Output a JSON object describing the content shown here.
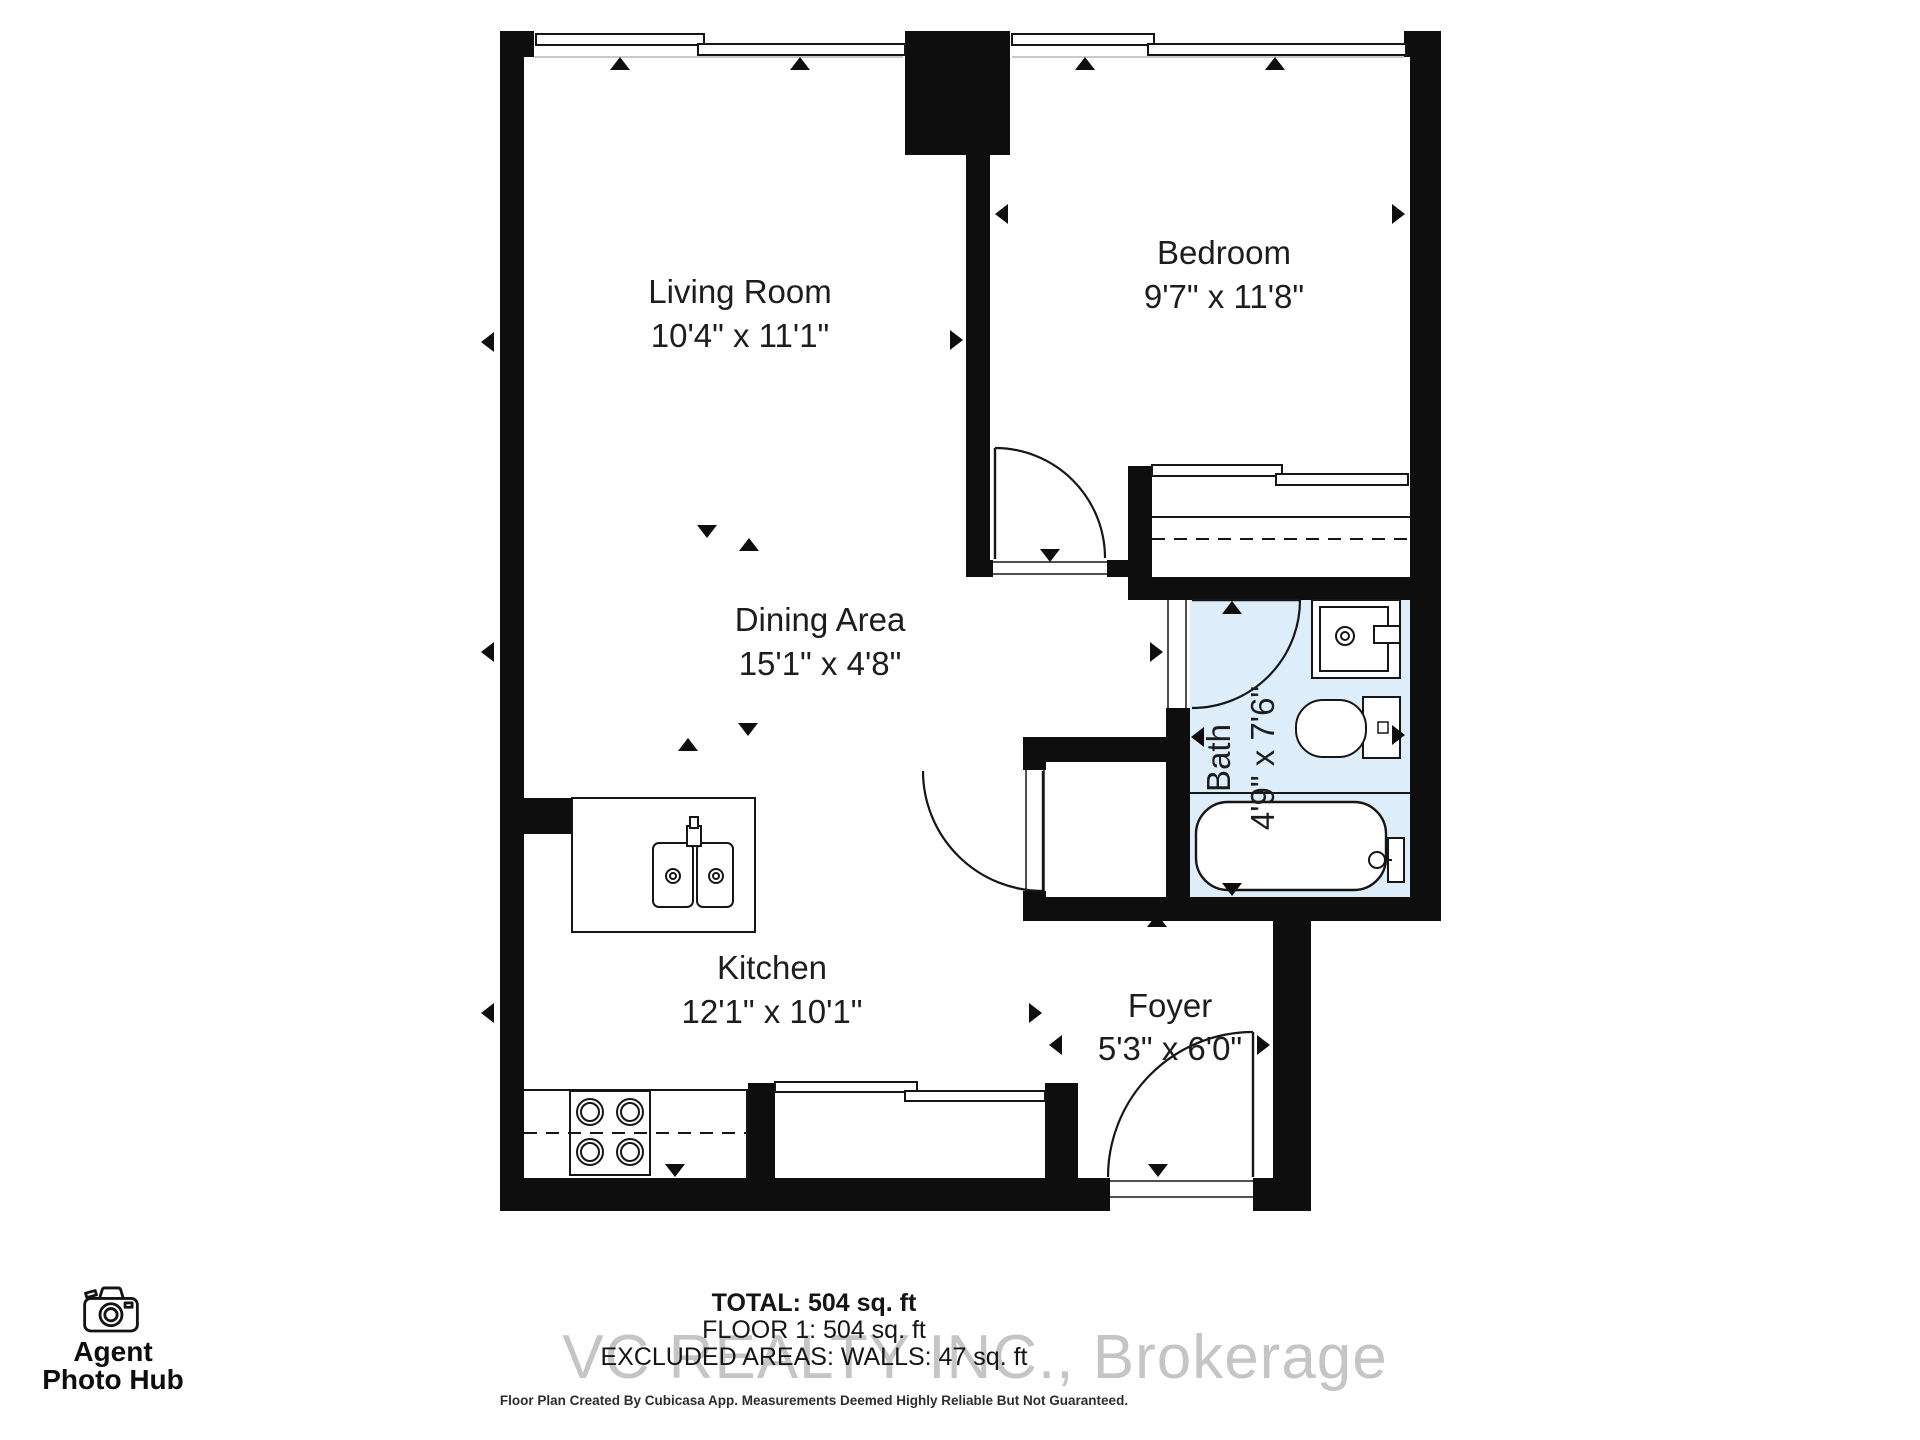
{
  "rooms": [
    {
      "id": "living-room",
      "label": "Living Room",
      "dims": "10'4\" x 11'1\"",
      "nx": 740,
      "ny": 303,
      "dx": 740,
      "dy": 347
    },
    {
      "id": "bedroom",
      "label": "Bedroom",
      "dims": "9'7\" x 11'8\"",
      "nx": 1224,
      "ny": 264,
      "dx": 1224,
      "dy": 308
    },
    {
      "id": "dining-area",
      "label": "Dining Area",
      "dims": "15'1\" x 4'8\"",
      "nx": 820,
      "ny": 631,
      "dx": 820,
      "dy": 675
    },
    {
      "id": "kitchen",
      "label": "Kitchen",
      "dims": "12'1\" x 10'1\"",
      "nx": 772,
      "ny": 979,
      "dx": 772,
      "dy": 1023
    },
    {
      "id": "foyer",
      "label": "Foyer",
      "dims": "5'3\" x 6'0\"",
      "nx": 1170,
      "ny": 1017,
      "dx": 1170,
      "dy": 1060
    },
    {
      "id": "bath",
      "label": "Bath",
      "dims": "4'9\" x 7'6\"",
      "nx": 1230,
      "ny": 758,
      "dx": 1274,
      "dy": 758,
      "rot": -90
    }
  ],
  "stats": {
    "total": "TOTAL: 504 sq. ft",
    "floor": "FLOOR 1: 504 sq. ft",
    "excluded": "EXCLUDED AREAS: WALLS: 47 sq. ft"
  },
  "watermark": "VC REALTY INC., Brokerage",
  "disclaimer": "Floor Plan Created By Cubicasa App. Measurements Deemed Highly Reliable But Not Guaranteed.",
  "logo": {
    "line1": "Agent",
    "line2": "Photo Hub"
  },
  "plan": {
    "wall_color": "#0e0e0e",
    "line_color": "#161616",
    "text_color": "#1d1d1d",
    "bath_fill": "#ddedf9",
    "window_inner_color": "#c9c9c9",
    "fills": [
      {
        "n": "bath-floor",
        "x": 1190,
        "y": 600,
        "w": 220,
        "h": 297,
        "c": "#ddedf9"
      }
    ],
    "walls": [
      [
        500,
        31,
        24,
        1180
      ],
      [
        500,
        31,
        34,
        26
      ],
      [
        905,
        31,
        105,
        124
      ],
      [
        1404,
        31,
        37,
        26
      ],
      [
        1410,
        31,
        31,
        890
      ],
      [
        966,
        155,
        24,
        406
      ],
      [
        966,
        560,
        28,
        17
      ],
      [
        1107,
        560,
        45,
        17
      ],
      [
        1128,
        466,
        24,
        111
      ],
      [
        1128,
        577,
        313,
        23
      ],
      [
        1166,
        708,
        24,
        213
      ],
      [
        1023,
        737,
        143,
        25
      ],
      [
        1023,
        737,
        23,
        35
      ],
      [
        1023,
        891,
        23,
        30
      ],
      [
        1023,
        897,
        418,
        24
      ],
      [
        1273,
        897,
        38,
        314
      ],
      [
        500,
        1178,
        610,
        33
      ],
      [
        1253,
        1178,
        58,
        33
      ],
      [
        748,
        1083,
        27,
        95
      ],
      [
        1045,
        1083,
        33,
        95
      ],
      [
        500,
        798,
        72,
        36
      ]
    ],
    "white_rects": [
      [
        993,
        560,
        114,
        17
      ],
      [
        1166,
        600,
        24,
        108
      ],
      [
        1023,
        770,
        23,
        121
      ],
      [
        1110,
        1178,
        143,
        33
      ]
    ],
    "pane_rects": [
      [
        536,
        34,
        168,
        11
      ],
      [
        698,
        44,
        207,
        11
      ],
      [
        1012,
        34,
        142,
        11
      ],
      [
        1148,
        44,
        258,
        11
      ],
      [
        1152,
        465,
        130,
        11
      ],
      [
        1276,
        474,
        132,
        11
      ],
      [
        775,
        1082,
        142,
        10
      ],
      [
        905,
        1091,
        140,
        10
      ]
    ],
    "outline_rects": [
      {
        "n": "kitchen-island",
        "x": 572,
        "y": 798,
        "w": 183,
        "h": 134,
        "sw": 2
      },
      {
        "n": "stove",
        "x": 570,
        "y": 1091,
        "w": 80,
        "h": 84,
        "sw": 2
      },
      {
        "n": "sink-basin-left",
        "x": 653,
        "y": 843,
        "w": 40,
        "h": 64,
        "rx": 6,
        "sw": 2
      },
      {
        "n": "sink-basin-right",
        "x": 697,
        "y": 843,
        "w": 36,
        "h": 64,
        "rx": 6,
        "sw": 2
      },
      {
        "n": "sink-faucet",
        "x": 687,
        "y": 826,
        "w": 14,
        "h": 20,
        "sw": 2
      },
      {
        "n": "sink-faucet-nub",
        "x": 690,
        "y": 817,
        "w": 8,
        "h": 11,
        "sw": 2
      },
      {
        "n": "bath-vanity",
        "x": 1312,
        "y": 600,
        "w": 88,
        "h": 78,
        "sw": 2
      },
      {
        "n": "bath-vanity-basin",
        "x": 1320,
        "y": 607,
        "w": 68,
        "h": 64,
        "sw": 2
      },
      {
        "n": "bath-vanity-soap",
        "x": 1374,
        "y": 626,
        "w": 26,
        "h": 17,
        "sw": 2
      },
      {
        "n": "toilet-tank",
        "x": 1363,
        "y": 697,
        "w": 37,
        "h": 61,
        "sw": 2
      },
      {
        "n": "toilet-button",
        "x": 1378,
        "y": 722,
        "w": 10,
        "h": 11,
        "sw": 1.5
      },
      {
        "n": "toilet-bowl",
        "x": 1296,
        "y": 700,
        "w": 70,
        "h": 57,
        "rx": 27,
        "sw": 2
      },
      {
        "n": "bathtub",
        "x": 1196,
        "y": 802,
        "w": 190,
        "h": 88,
        "rx": 32,
        "sw": 2.4
      },
      {
        "n": "tub-faucet-mount",
        "x": 1388,
        "y": 838,
        "w": 16,
        "h": 44,
        "sw": 2
      }
    ],
    "lines": [
      {
        "n": "window-inner-left",
        "x1": 534,
        "y1": 57,
        "x2": 903,
        "y2": 57,
        "w": 2,
        "c": "#c9c9c9"
      },
      {
        "n": "window-inner-right",
        "x1": 1012,
        "y1": 57,
        "x2": 1404,
        "y2": 57,
        "w": 2,
        "c": "#c9c9c9"
      },
      {
        "n": "closet-shelf",
        "x1": 1152,
        "y1": 517,
        "x2": 1410,
        "y2": 517,
        "w": 2
      },
      {
        "n": "closet-rod",
        "x1": 1152,
        "y1": 539,
        "x2": 1410,
        "y2": 539,
        "w": 2,
        "dash": "13,9"
      },
      {
        "n": "bath-divider",
        "x1": 1190,
        "y1": 793,
        "x2": 1410,
        "y2": 793,
        "w": 2
      },
      {
        "n": "counter-edge",
        "x1": 524,
        "y1": 1090,
        "x2": 748,
        "y2": 1090,
        "w": 2
      },
      {
        "n": "counter-end",
        "x1": 747,
        "y1": 1090,
        "x2": 747,
        "y2": 1178,
        "w": 2
      },
      {
        "n": "counter-dash",
        "x1": 524,
        "y1": 1133,
        "x2": 747,
        "y2": 1133,
        "w": 2,
        "dash": "13,9"
      },
      {
        "n": "threshold",
        "x1": 993,
        "y1": 562,
        "x2": 1107,
        "y2": 562,
        "w": 1.5
      },
      {
        "n": "threshold",
        "x1": 993,
        "y1": 574,
        "x2": 1107,
        "y2": 574,
        "w": 1.5
      },
      {
        "n": "threshold",
        "x1": 1168,
        "y1": 600,
        "x2": 1168,
        "y2": 708,
        "w": 1.5
      },
      {
        "n": "threshold",
        "x1": 1186,
        "y1": 600,
        "x2": 1186,
        "y2": 708,
        "w": 1.5
      },
      {
        "n": "threshold",
        "x1": 1026,
        "y1": 770,
        "x2": 1026,
        "y2": 891,
        "w": 1.5
      },
      {
        "n": "threshold",
        "x1": 1044,
        "y1": 770,
        "x2": 1044,
        "y2": 891,
        "w": 1.5
      },
      {
        "n": "threshold",
        "x1": 1110,
        "y1": 1181,
        "x2": 1253,
        "y2": 1181,
        "w": 1.5
      },
      {
        "n": "threshold",
        "x1": 1110,
        "y1": 1197,
        "x2": 1253,
        "y2": 1197,
        "w": 1.5
      },
      {
        "n": "door-leaf",
        "x1": 995,
        "y1": 448,
        "x2": 995,
        "y2": 559,
        "w": 2.4
      },
      {
        "n": "door-leaf",
        "x1": 1192,
        "y1": 600,
        "x2": 1300,
        "y2": 600,
        "w": 2.4
      },
      {
        "n": "door-leaf",
        "x1": 1043,
        "y1": 771,
        "x2": 1043,
        "y2": 891,
        "w": 2.4
      },
      {
        "n": "door-leaf",
        "x1": 1253,
        "y1": 1032,
        "x2": 1253,
        "y2": 1177,
        "w": 2.4
      },
      {
        "n": "tub-spout-stem",
        "x1": 1385,
        "y1": 860,
        "x2": 1392,
        "y2": 860,
        "w": 2
      }
    ],
    "circles": [
      {
        "n": "sink-drain",
        "x": 673,
        "y": 876,
        "r": 7
      },
      {
        "n": "sink-drain",
        "x": 673,
        "y": 876,
        "r": 3
      },
      {
        "n": "sink-drain",
        "x": 716,
        "y": 876,
        "r": 7
      },
      {
        "n": "sink-drain",
        "x": 716,
        "y": 876,
        "r": 3
      },
      {
        "n": "burner",
        "x": 590,
        "y": 1112,
        "r": 13
      },
      {
        "n": "burner",
        "x": 590,
        "y": 1112,
        "r": 9
      },
      {
        "n": "burner",
        "x": 630,
        "y": 1112,
        "r": 13
      },
      {
        "n": "burner",
        "x": 630,
        "y": 1112,
        "r": 9
      },
      {
        "n": "burner",
        "x": 590,
        "y": 1152,
        "r": 13
      },
      {
        "n": "burner",
        "x": 590,
        "y": 1152,
        "r": 9
      },
      {
        "n": "burner",
        "x": 630,
        "y": 1152,
        "r": 13
      },
      {
        "n": "burner",
        "x": 630,
        "y": 1152,
        "r": 9
      },
      {
        "n": "vanity-drain",
        "x": 1345,
        "y": 636,
        "r": 9
      },
      {
        "n": "vanity-drain",
        "x": 1345,
        "y": 636,
        "r": 4
      },
      {
        "n": "tub-spout",
        "x": 1377,
        "y": 860,
        "r": 8
      }
    ],
    "arcs": [
      {
        "n": "bedroom-door-arc",
        "d": "M995,448 A110,110 0 0 1 1105,558"
      },
      {
        "n": "bath-door-arc",
        "d": "M1300,600 A108,108 0 0 1 1192,708"
      },
      {
        "n": "closet-door-arc",
        "d": "M923,771 A120,120 0 0 0 1043,891"
      },
      {
        "n": "entry-door-arc",
        "d": "M1253,1032 A145,145 0 0 0 1108,1177"
      }
    ],
    "triangles": [
      [
        620,
        64,
        "up"
      ],
      [
        800,
        64,
        "up"
      ],
      [
        1085,
        64,
        "up"
      ],
      [
        1275,
        64,
        "up"
      ],
      [
        707,
        531,
        "down"
      ],
      [
        749,
        545,
        "up"
      ],
      [
        748,
        729,
        "down"
      ],
      [
        688,
        745,
        "up"
      ],
      [
        675,
        1170,
        "down"
      ],
      [
        488,
        342,
        "left"
      ],
      [
        956,
        340,
        "right"
      ],
      [
        1002,
        214,
        "left"
      ],
      [
        1398,
        214,
        "right"
      ],
      [
        488,
        652,
        "left"
      ],
      [
        1156,
        652,
        "right"
      ],
      [
        488,
        1013,
        "left"
      ],
      [
        1035,
        1013,
        "right"
      ],
      [
        1056,
        1045,
        "left"
      ],
      [
        1263,
        1045,
        "right"
      ],
      [
        1157,
        921,
        "up"
      ],
      [
        1158,
        1170,
        "down"
      ],
      [
        1232,
        608,
        "up"
      ],
      [
        1232,
        889,
        "down"
      ],
      [
        1198,
        737,
        "left"
      ],
      [
        1398,
        735,
        "right"
      ],
      [
        1050,
        555,
        "down"
      ]
    ]
  }
}
